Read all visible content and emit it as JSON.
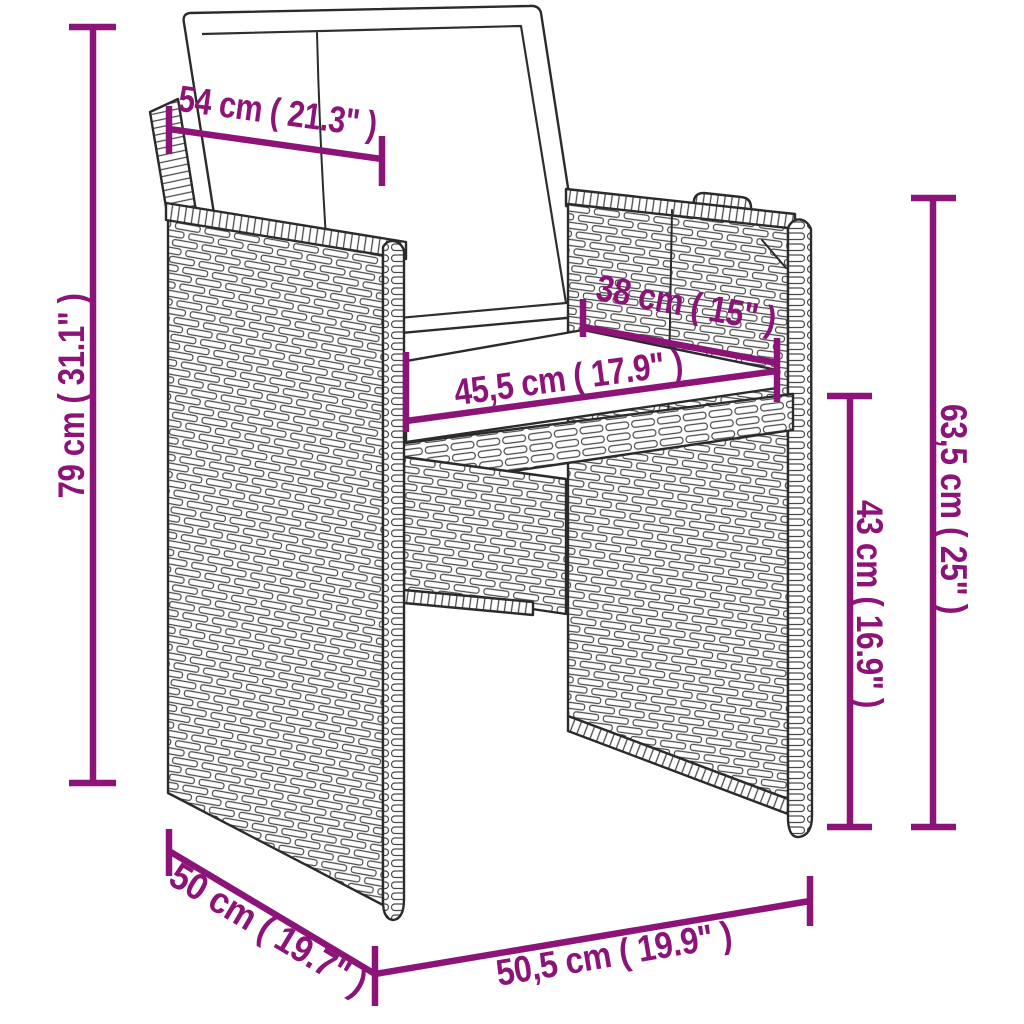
{
  "diagram": {
    "subject": "poly-rattan-armchair-with-cushions",
    "accent_color": "#8c1377",
    "outline_color": "#2b2b2b",
    "background_color": "#ffffff",
    "dimensions": [
      {
        "name": "overall-height",
        "cm": "79",
        "inches": "31.1",
        "label": "79 cm ( 31.1\" )"
      },
      {
        "name": "backrest-width",
        "cm": "54",
        "inches": "21.3",
        "label": "54 cm ( 21.3\" )"
      },
      {
        "name": "seat-depth",
        "cm": "38",
        "inches": "15",
        "label": "38 cm ( 15\" )"
      },
      {
        "name": "seat-width",
        "cm": "45,5",
        "inches": "17.9",
        "label": "45,5 cm ( 17.9\" )"
      },
      {
        "name": "armrest-height",
        "cm": "63,5",
        "inches": "25",
        "label": "63,5 cm ( 25\" )"
      },
      {
        "name": "seat-height",
        "cm": "43",
        "inches": "16.9",
        "label": "43 cm ( 16.9\" )"
      },
      {
        "name": "overall-depth",
        "cm": "50",
        "inches": "19.7",
        "label": "50 cm ( 19.7\" )"
      },
      {
        "name": "overall-width",
        "cm": "50,5",
        "inches": "19.9",
        "label": "50,5 cm ( 19.9\" )"
      }
    ]
  }
}
